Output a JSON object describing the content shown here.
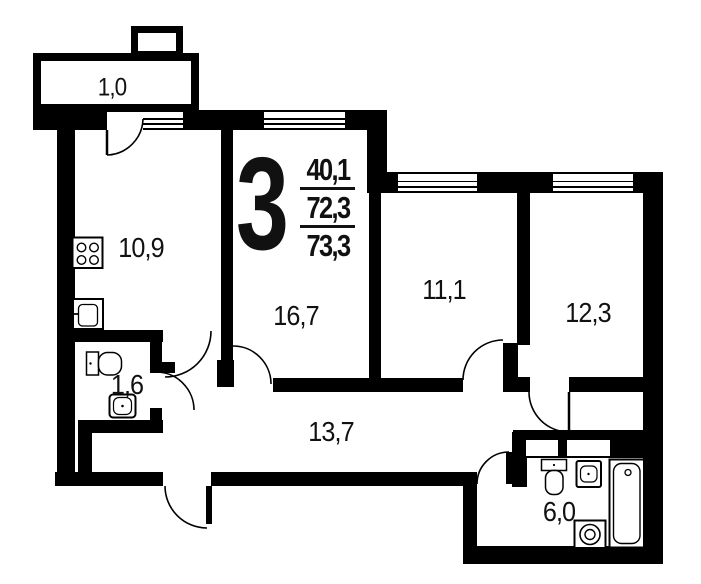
{
  "plan": {
    "apartment_type": "3",
    "areas": [
      "40,1",
      "72,3",
      "73,3"
    ],
    "rooms": {
      "balcony": "1,0",
      "kitchen": "10,9",
      "wc": "1,6",
      "living_room": "16,7",
      "hallway": "13,7",
      "bedroom_1": "11,1",
      "bedroom_2": "12,3",
      "bathroom": "6,0"
    },
    "colors": {
      "wall": "#000000",
      "background": "#ffffff"
    }
  }
}
